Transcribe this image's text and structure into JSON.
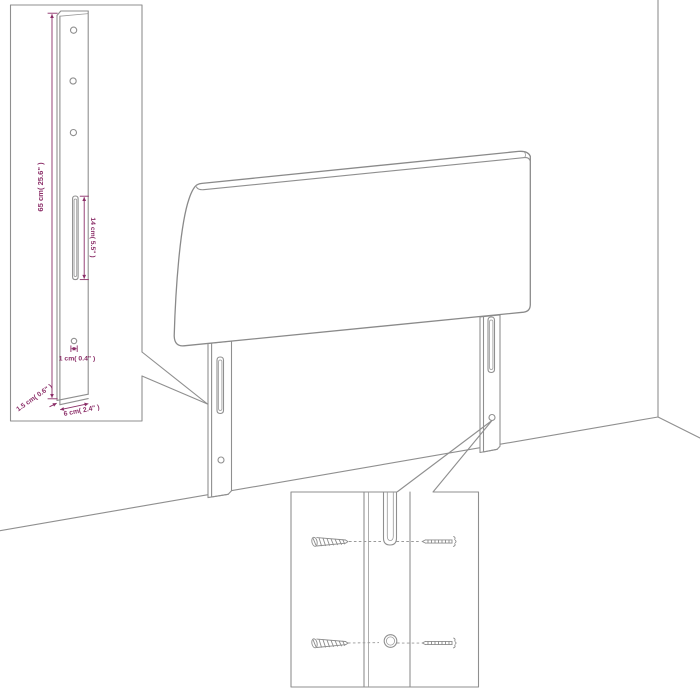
{
  "figure_title": "Headboard with legs - assembly and dimension diagram",
  "colors": {
    "background": "#ffffff",
    "line_art": "#8f8f8f",
    "dimension_accent": "#8b2e68"
  },
  "leg_detail_inset": {
    "dim_height": "65 cm( 25.6\" )",
    "dim_slot": "14 cm( 5.5\" )",
    "dim_hole": "1 cm( 0.4\" )",
    "dim_thickness": "1.5 cm( 0.6\" )",
    "dim_width": "6 cm( 2.4\" )",
    "top_hole_count": 3,
    "slot_count": 1,
    "bottom_hole_count": 1
  },
  "headboard": {
    "panel_count": 1,
    "leg_count": 2,
    "slots_per_leg": 1,
    "holes_per_leg": 1
  },
  "mounting_detail_inset": {
    "left_screw_count": 2,
    "right_screw_count": 2,
    "slot_count": 1,
    "hole_count": 1
  },
  "scene": {
    "setting": "wall corner with floor lines"
  }
}
